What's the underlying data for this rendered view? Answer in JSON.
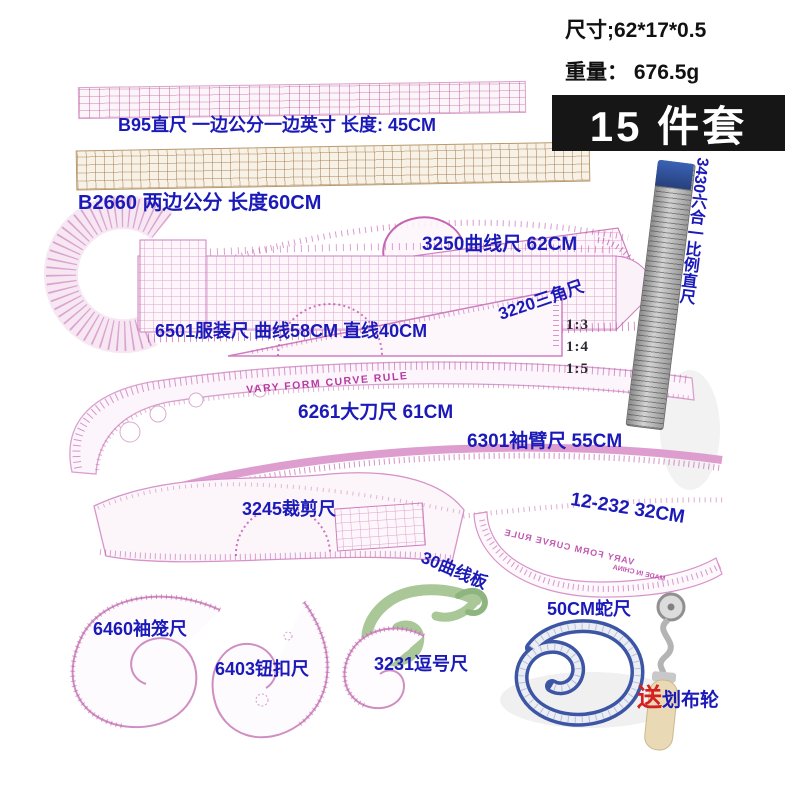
{
  "meta": {
    "size": "尺寸;62*17*0.5",
    "weight": "重量： 676.5g",
    "badge": "15 件套"
  },
  "labels": {
    "b95": "B95直尺 一边公分一边英寸 长度: 45CM",
    "b2660": "B2660 两边公分   长度60CM",
    "r3430": "3430六合一比例直尺",
    "r3250": "3250曲线尺 62CM",
    "r3220": "3220三角尺",
    "r6501": "6501服装尺 曲线58CM 直线40CM",
    "r6261": "6261大刀尺 61CM",
    "r6301": "6301袖臂尺  55CM",
    "r3245": "3245裁剪尺",
    "r12232": "12-232  32CM",
    "r30": "30曲线板",
    "r6460": "6460袖笼尺",
    "r6403": "6403钮扣尺",
    "r3231": "3231逗号尺",
    "snake": "50CM蛇尺",
    "gift": "送",
    "gift_tool": "划布轮"
  },
  "ratios": {
    "r3": "1:3",
    "r4": "1:4",
    "r5": "1:5"
  },
  "printed": {
    "vary_form": "VARY FORM CURVE RULE",
    "made_in_china": "MADE IN CHINA"
  },
  "colors": {
    "label_blue": "#1b1ab8",
    "gift_red": "#d42020",
    "print_magenta": "#b73aa0",
    "ruler_tan": "#b99a6e",
    "template_green": "#a9c797",
    "snake_blue": "#3c55a5",
    "badge_bg": "#161616",
    "wood": "#e9d9b4"
  }
}
